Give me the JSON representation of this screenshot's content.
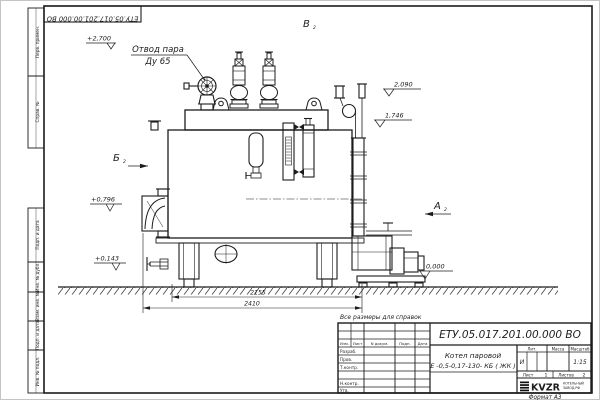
{
  "sheet": {
    "top_stamp": "ЕТУ.05.017.201.00.000 ВО",
    "reference_note": "Все размеры для справок",
    "format_label": "Формат А3"
  },
  "frame_stamps": {
    "top": [
      "Перв. примен.",
      "Справ. №"
    ],
    "bottom": [
      "Подп. и дата",
      "Инв. № дубл.",
      "Взам. инв. №",
      "Подп. и дата",
      "Инв. № подл."
    ]
  },
  "annotations": {
    "steam_outlet": {
      "line1": "Отвод пара",
      "line2": "Ду 65"
    },
    "elevations": {
      "top": "+2,700",
      "e2090": "2,090",
      "e1746": "1,746",
      "e0796": "+0,796",
      "e0143": "+0,143",
      "zero": "0,000"
    },
    "views": {
      "b": "Б",
      "v": "В",
      "a": "А",
      "sub": "2"
    },
    "dimensions": {
      "inner": "2155",
      "outer": "2410"
    }
  },
  "title_block": {
    "doc_number": "ЕТУ.05.017.201.00.000 ВО",
    "product_name": {
      "line1": "Котел паровой",
      "line2": "Е -0,5-0,17-130- КБ ( ЖК )"
    },
    "columns": [
      "Изм.",
      "Лист",
      "N докум.",
      "Подп.",
      "Дата"
    ],
    "roles": [
      "Разраб.",
      "Пров.",
      "Т.контр.",
      "Н.контр.",
      "Утв."
    ],
    "lit": {
      "label": "Лит.",
      "value": "И"
    },
    "mass": {
      "label": "Масса"
    },
    "scale": {
      "label": "Масштаб",
      "value": "1:15"
    },
    "sheet_no": {
      "label": "Лист",
      "value": "1"
    },
    "sheets_total": {
      "label": "Листов",
      "value": "2"
    },
    "logo": {
      "text": "KVZR",
      "sub1": "КОТЕЛЬНЫЙ",
      "sub2": "ЗАВОД.РФ"
    }
  }
}
